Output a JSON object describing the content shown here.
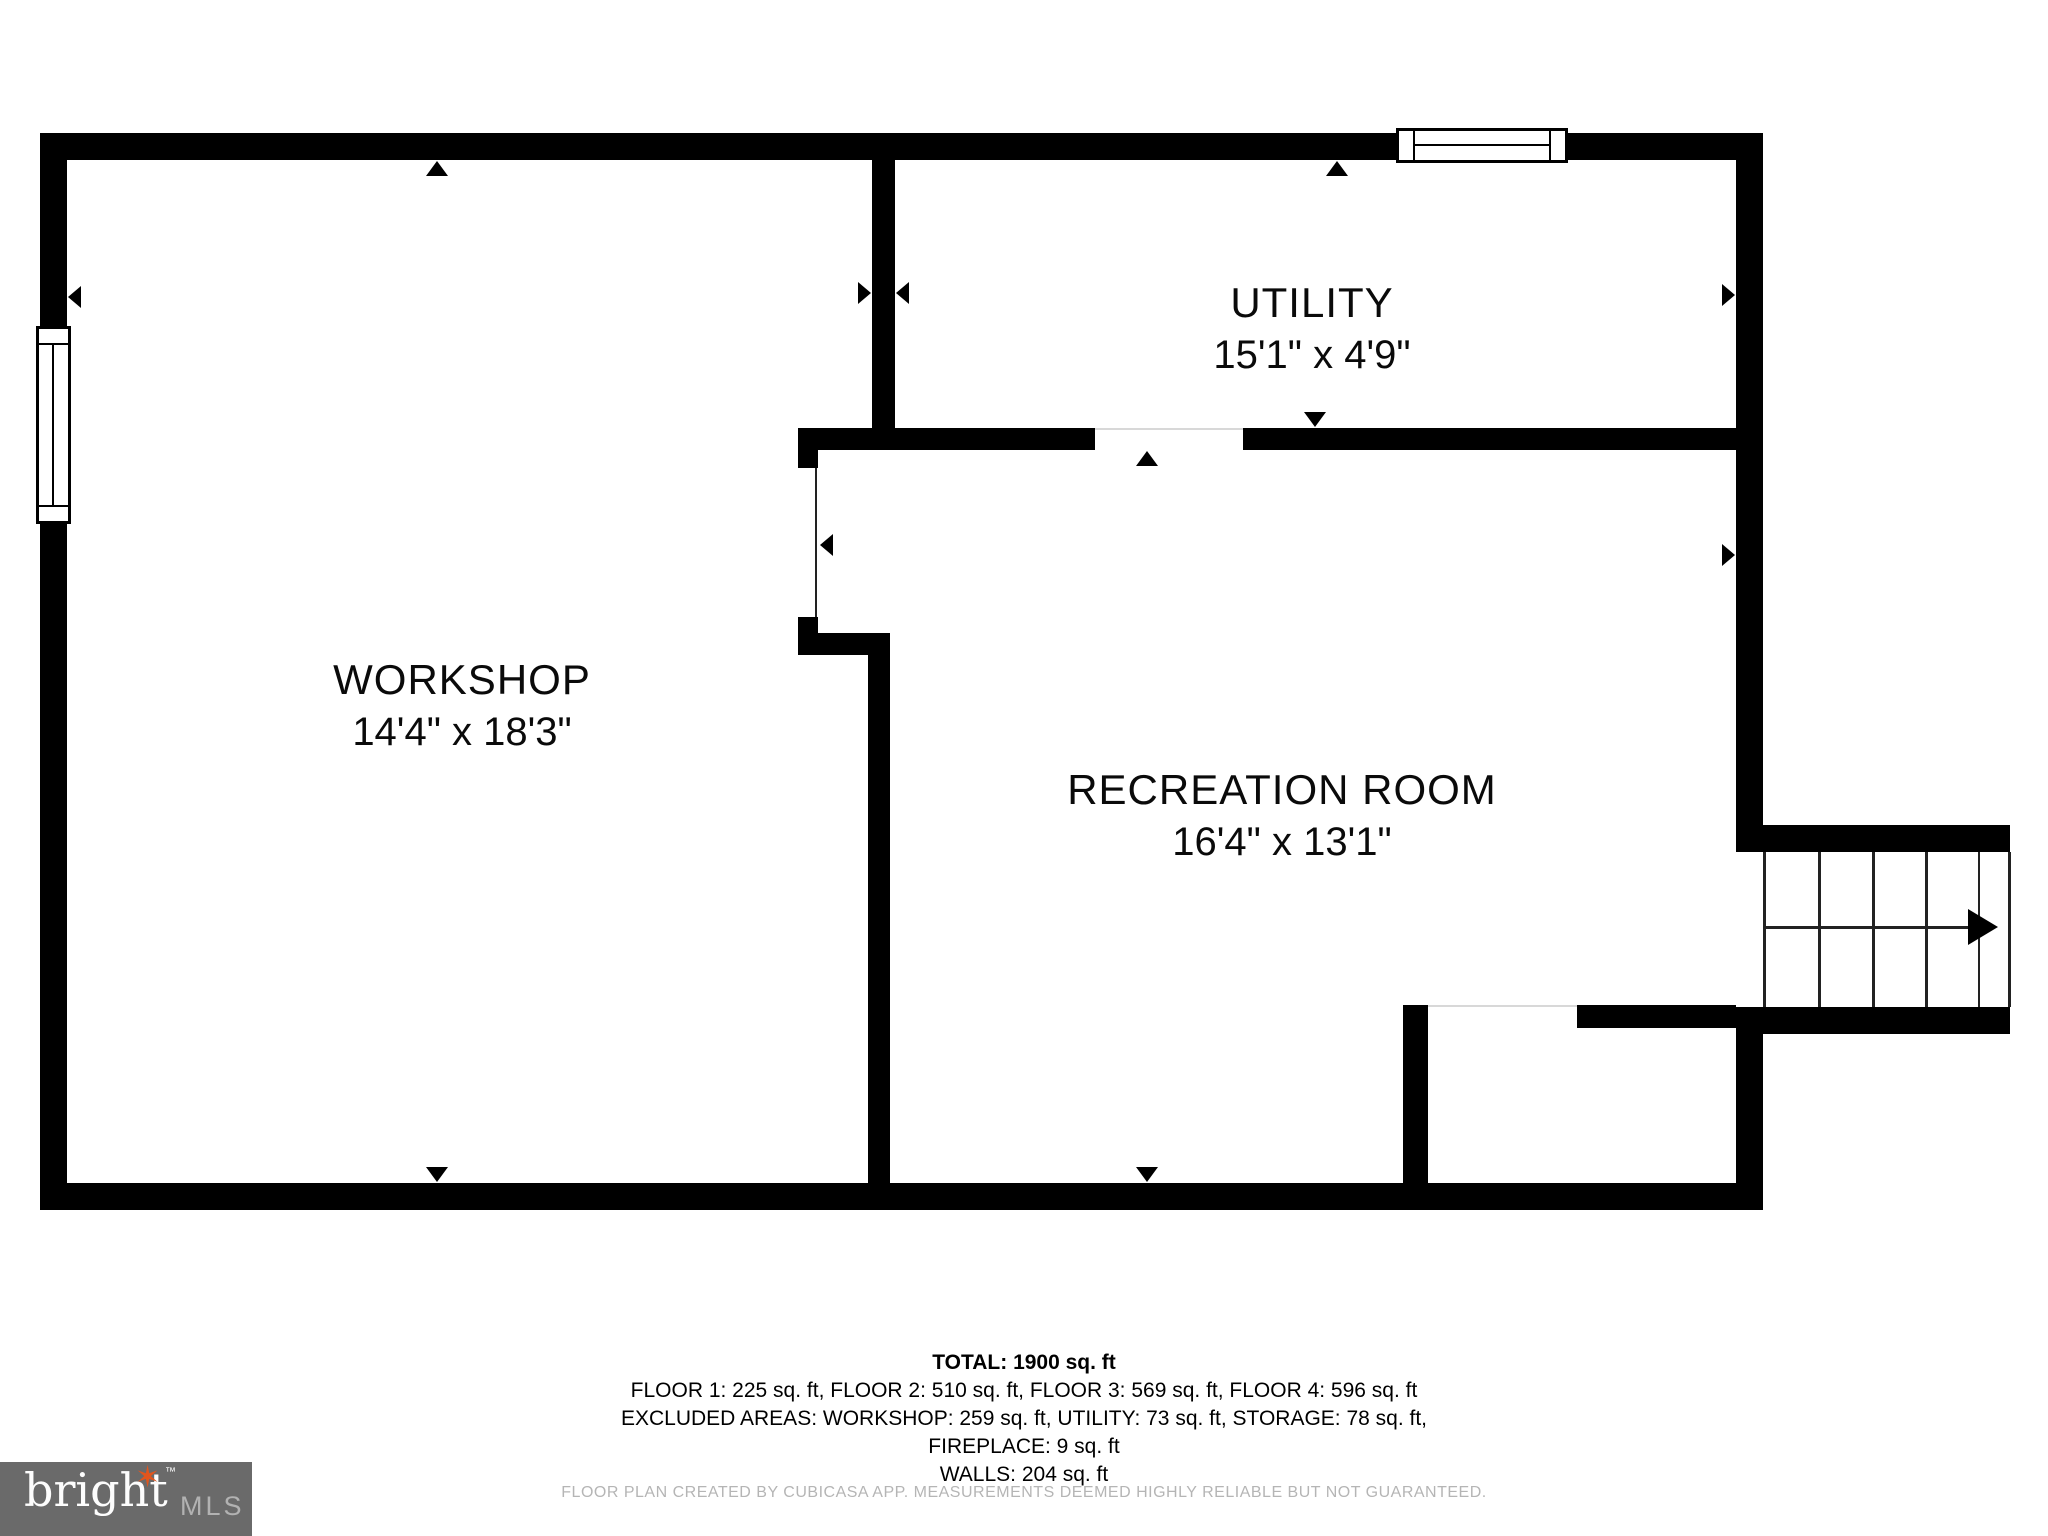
{
  "rooms": {
    "workshop": {
      "name": "WORKSHOP",
      "dims": "14'4\" x 18'3\""
    },
    "utility": {
      "name": "UTILITY",
      "dims": "15'1\" x 4'9\""
    },
    "recreation": {
      "name": "RECREATION ROOM",
      "dims": "16'4\" x 13'1\""
    }
  },
  "footer": {
    "total": "TOTAL: 1900 sq. ft",
    "floors": "FLOOR 1: 225 sq. ft, FLOOR 2: 510 sq. ft, FLOOR 3: 569 sq. ft, FLOOR 4: 596 sq. ft",
    "excluded": "EXCLUDED AREAS: WORKSHOP: 259 sq. ft, UTILITY: 73 sq. ft, STORAGE: 78 sq. ft,",
    "fireplace": "FIREPLACE: 9 sq. ft",
    "walls": "WALLS: 204 sq. ft",
    "disclaimer": "FLOOR PLAN CREATED BY CUBICASA APP. MEASUREMENTS DEEMED HIGHLY RELIABLE BUT NOT GUARANTEED."
  },
  "logo": {
    "brand": "bright",
    "tm": "™",
    "suffix": "MLS"
  },
  "colors": {
    "wall": "#000000",
    "background": "#ffffff",
    "disclaimer_text": "#b5b5b5",
    "logo_background": "#6a6a6a",
    "logo_star": "#e2551c"
  }
}
